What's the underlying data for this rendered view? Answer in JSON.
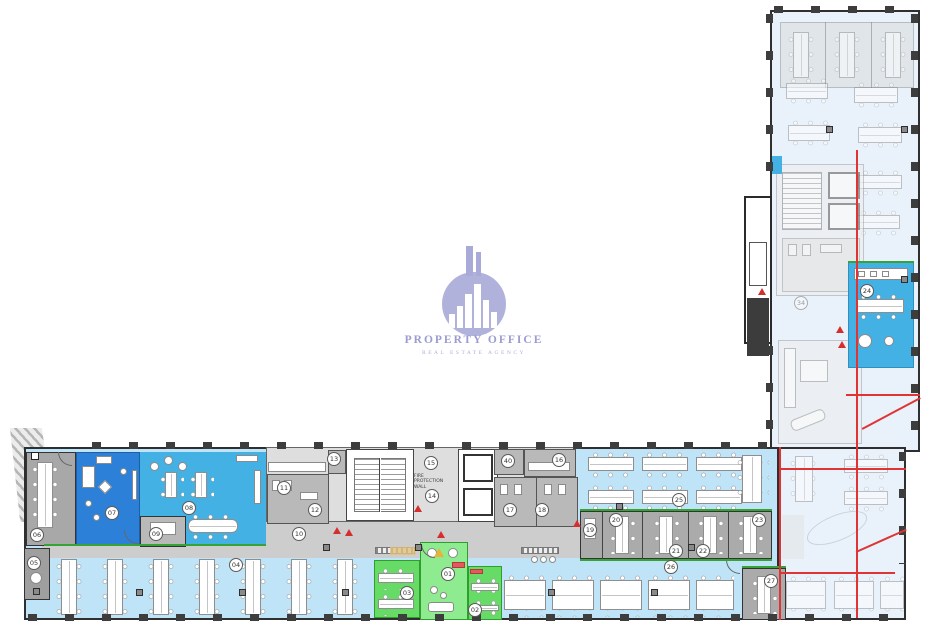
{
  "logo": {
    "title": "PROPERTY OFFICE",
    "subtitle": "REAL ESTATE AGENCY"
  },
  "labels": {
    "fire_wall": "FIRE PROTECTION WALL"
  },
  "room_labels": {
    "r01": "01",
    "r02": "02",
    "r03": "03",
    "r04": "04",
    "r05": "05",
    "r06": "06",
    "r07": "07",
    "r08": "08",
    "r09": "09",
    "r10": "10",
    "r11": "11",
    "r12": "12",
    "r13": "13",
    "r14": "14",
    "r15": "15",
    "r16": "16",
    "r17": "17",
    "r18": "18",
    "r19": "19",
    "r20": "20",
    "r21": "21",
    "r22": "22",
    "r23": "23",
    "r24": "24",
    "r25": "25",
    "r26": "26",
    "r27": "27",
    "r34": "34",
    "r40": "40"
  },
  "colors": {
    "bright_blue": "#2d80d8",
    "medium_blue": "#44b1e4",
    "light_blue": "#bfe3f7",
    "faded_blue": "#e9f2fa",
    "green_light": "#8feb8f",
    "green_medium": "#66db66",
    "gray_room": "#ababab",
    "corridor_gray": "#cdcdcd",
    "boundary_red": "#e03434",
    "logo_lavender": "#a9aad8"
  }
}
